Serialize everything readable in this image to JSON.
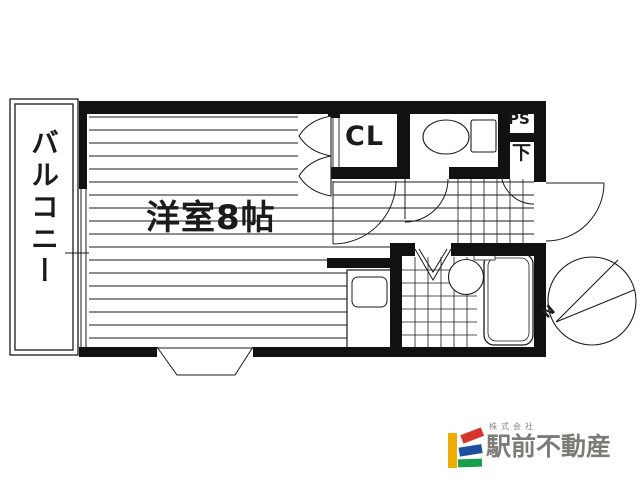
{
  "floorplan": {
    "balcony_label": "バルコニー",
    "room_label": "洋室8帖",
    "closet_label": "CL",
    "pipe_space_label": "PS",
    "shoe_box_label": "下",
    "compass_north_label": "N"
  },
  "logo": {
    "company_prefix": "株式会社",
    "company_name": "駅前不動産"
  },
  "colors": {
    "line": "#1b1b1b",
    "logo_yellow": "#efac00",
    "logo_red": "#d8352a",
    "logo_blue": "#1c4f9c",
    "logo_green": "#16a04b",
    "logo_text": "#7c7b75"
  }
}
